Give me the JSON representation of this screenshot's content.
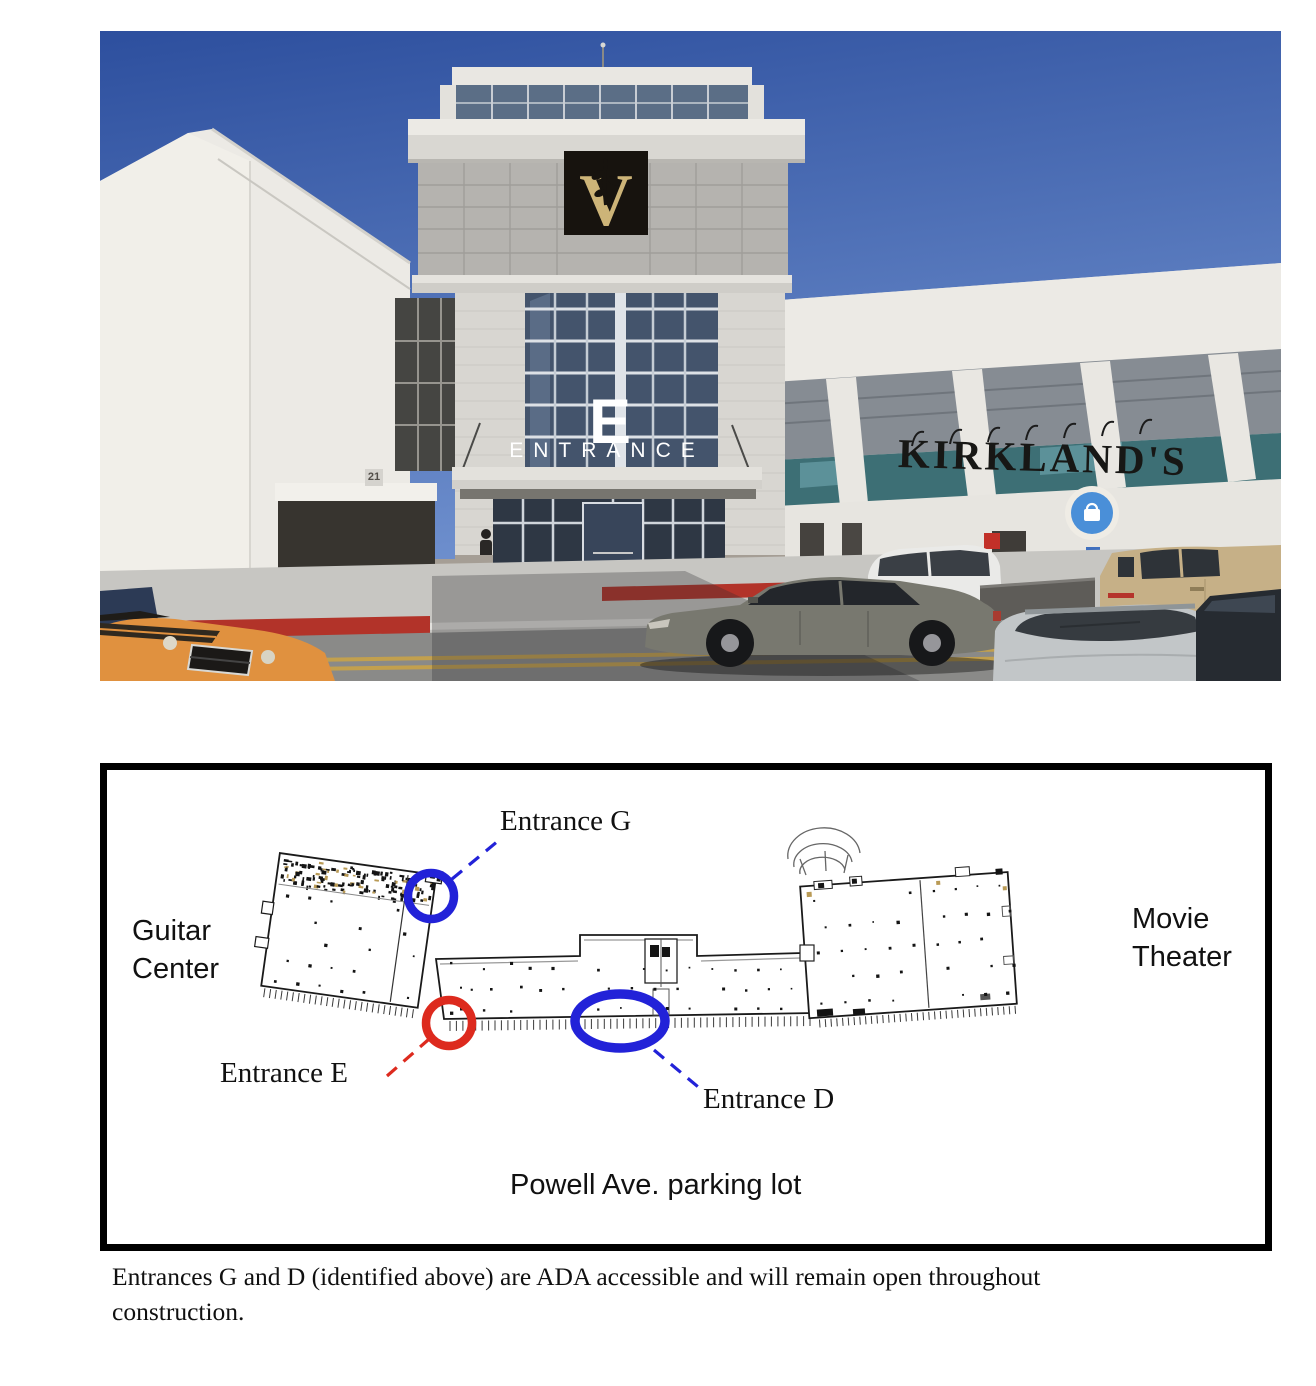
{
  "photo": {
    "description": "Street-view photo of the shopping center Entrance E tower with Kirkland's storefront and parked cars",
    "signs": {
      "entrance_letter": "E",
      "entrance_word": "ENTRANCE",
      "store_name": "KIRKLAND'S",
      "address_number": "21"
    },
    "colors": {
      "sky_top": "#2d4f9e",
      "sky_bottom": "#7a9bd6",
      "tower_panel": "#b5b3af",
      "logo_black": "#17130e",
      "logo_gold": "#cdb478",
      "store_badge_blue": "#4a8fd8",
      "glass_dark": "#44546c",
      "teal_glass": "#3d6f75",
      "asphalt": "#8a8a88",
      "road_line_yellow": "#c2a04e",
      "curb_red": "#b23329",
      "car_orange": "#e0913f",
      "car_gray": "#78786f",
      "car_tan": "#c6b087",
      "car_white": "#eaeae8",
      "car_silver": "#c2c6c8",
      "car_dark": "#262b31"
    }
  },
  "plan": {
    "labels": {
      "entrance_g": "Entrance G",
      "entrance_e": "Entrance E",
      "entrance_d": "Entrance D",
      "guitar_center": "Guitar Center",
      "movie_theater": "Movie Theater",
      "parking_lot": "Powell Ave. parking lot"
    },
    "marker_colors": {
      "blue": "#2222d8",
      "red": "#dd2a1e"
    }
  },
  "caption": {
    "text": "Entrances G and D (identified above) are ADA accessible and will remain open throughout construction."
  }
}
